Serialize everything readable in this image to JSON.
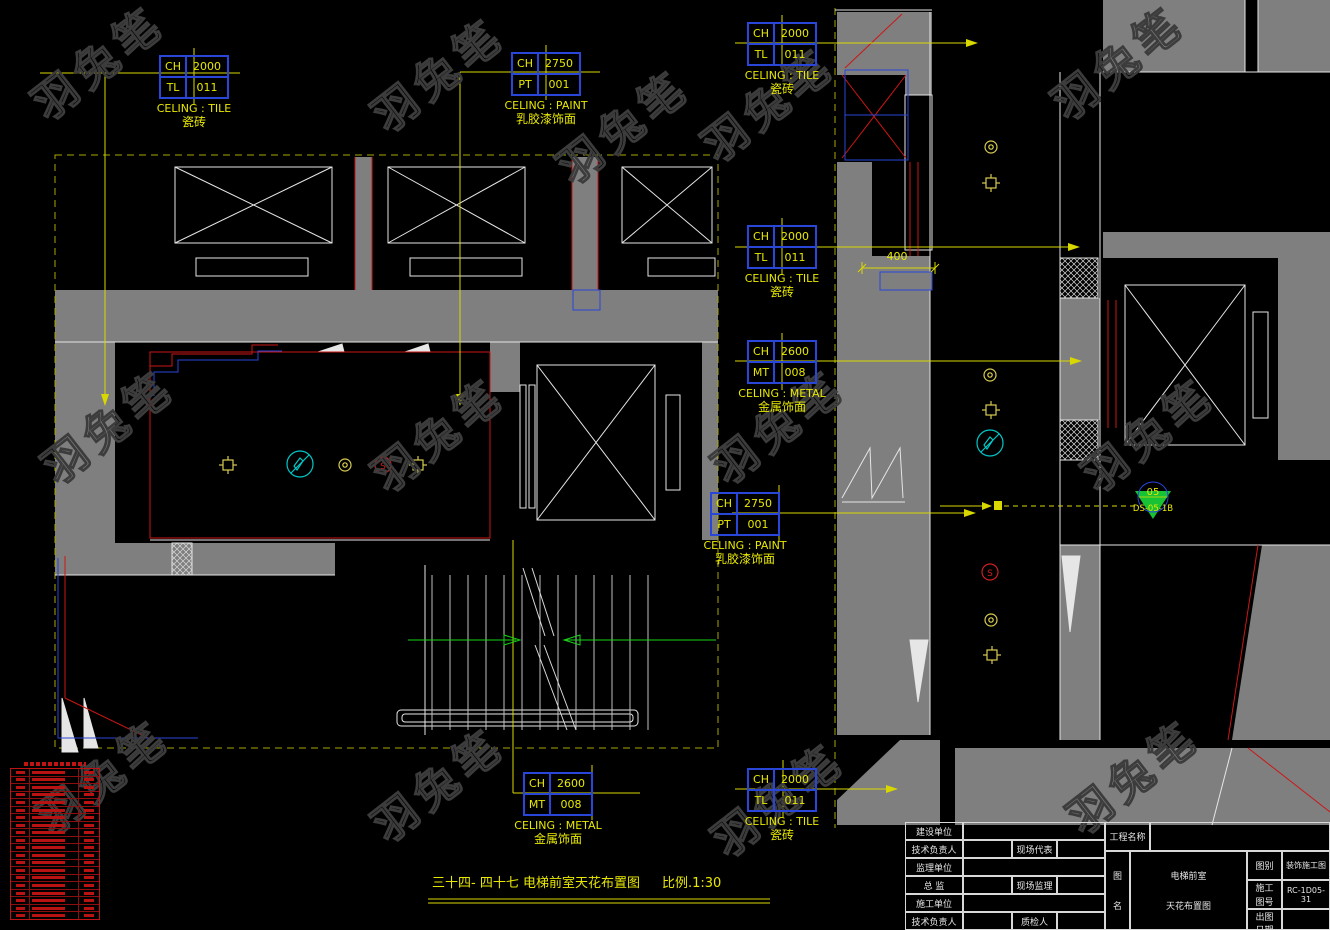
{
  "watermark": {
    "text": "羽兔笔"
  },
  "finish_tags": [
    {
      "rows": [
        [
          "CH",
          "2000"
        ],
        [
          "TL",
          "011"
        ]
      ],
      "caption_en": "CELING : TILE",
      "caption_cn": "瓷砖"
    },
    {
      "rows": [
        [
          "CH",
          "2750"
        ],
        [
          "PT",
          "001"
        ]
      ],
      "caption_en": "CELING : PAINT",
      "caption_cn": "乳胶漆饰面"
    },
    {
      "rows": [
        [
          "CH",
          "2000"
        ],
        [
          "TL",
          "011"
        ]
      ],
      "caption_en": "CELING : TILE",
      "caption_cn": "瓷砖"
    },
    {
      "rows": [
        [
          "CH",
          "2000"
        ],
        [
          "TL",
          "011"
        ]
      ],
      "caption_en": "CELING : TILE",
      "caption_cn": "瓷砖"
    },
    {
      "rows": [
        [
          "CH",
          "2600"
        ],
        [
          "MT",
          "008"
        ]
      ],
      "caption_en": "CELING : METAL",
      "caption_cn": "金属饰面"
    },
    {
      "rows": [
        [
          "CH",
          "2750"
        ],
        [
          "PT",
          "001"
        ]
      ],
      "caption_en": "CELING : PAINT",
      "caption_cn": "乳胶漆饰面"
    },
    {
      "rows": [
        [
          "CH",
          "2600"
        ],
        [
          "MT",
          "008"
        ]
      ],
      "caption_en": "CELING : METAL",
      "caption_cn": "金属饰面"
    },
    {
      "rows": [
        [
          "CH",
          "2000"
        ],
        [
          "TL",
          "011"
        ]
      ],
      "caption_en": "CELING : TILE",
      "caption_cn": "瓷砖"
    }
  ],
  "dimensions": {
    "corridor_width": "400"
  },
  "section_marker": {
    "number": "05",
    "sheet": "DS-05-1B"
  },
  "symbols": {
    "smoke_glyph": "S"
  },
  "drawing_title": {
    "text": "三十四- 四十七  电梯前室天花布置图",
    "scale": "比例.1:30"
  },
  "legend": {
    "row_count": 20
  },
  "title_block": {
    "rows": [
      {
        "label": "建设单位"
      },
      {
        "label": "技术负责人",
        "label2": "现场代表"
      },
      {
        "label": "监理单位"
      },
      {
        "label": "总  监",
        "label2": "现场监理"
      },
      {
        "label": "施工单位"
      },
      {
        "label": "技术负责人",
        "label2": "质检人"
      }
    ],
    "project_label": "工程名称",
    "fig_label_chars": [
      "图",
      "名"
    ],
    "figure_name_lines": [
      "电梯前室",
      "天花布置图"
    ],
    "fields": [
      {
        "label_lines": [
          "图别"
        ],
        "value": "装饰施工图"
      },
      {
        "label_lines": [
          "施工",
          "图号"
        ],
        "value": "RC-1D05-31"
      },
      {
        "label_lines": [
          "出图",
          "日期"
        ],
        "value": ""
      }
    ]
  }
}
